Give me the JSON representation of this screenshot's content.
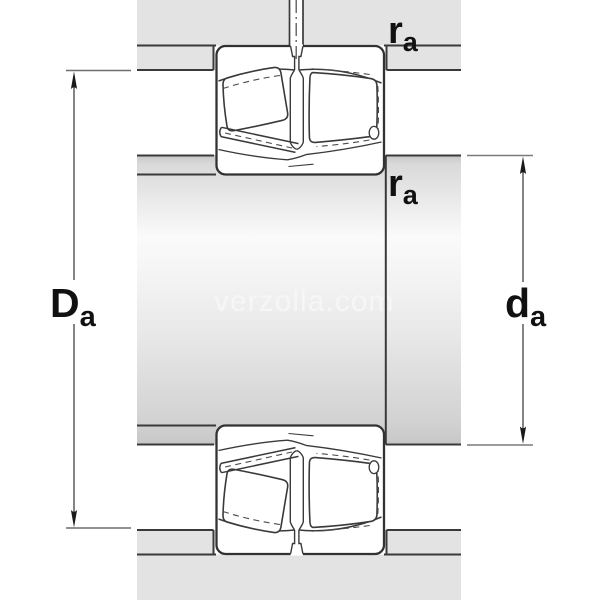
{
  "diagram": {
    "type": "bearing-mounting-cross-section",
    "watermark": "verzolla.com",
    "labels": {
      "housing_abutment_diameter": {
        "base": "D",
        "sub": "a"
      },
      "shaft_abutment_diameter": {
        "base": "d",
        "sub": "a"
      },
      "housing_fillet_radius": {
        "base": "r",
        "sub": "a"
      },
      "shaft_fillet_radius": {
        "base": "r",
        "sub": "a"
      }
    },
    "colors": {
      "background": "#ffffff",
      "housing_fill": "#e3e3e3",
      "outline": "#3a3a3a",
      "dimension_line": "#4f4f4f",
      "tick_line": "#7a7a7a",
      "label_text": "#111111",
      "watermark_text": "#f8f8f8"
    }
  }
}
